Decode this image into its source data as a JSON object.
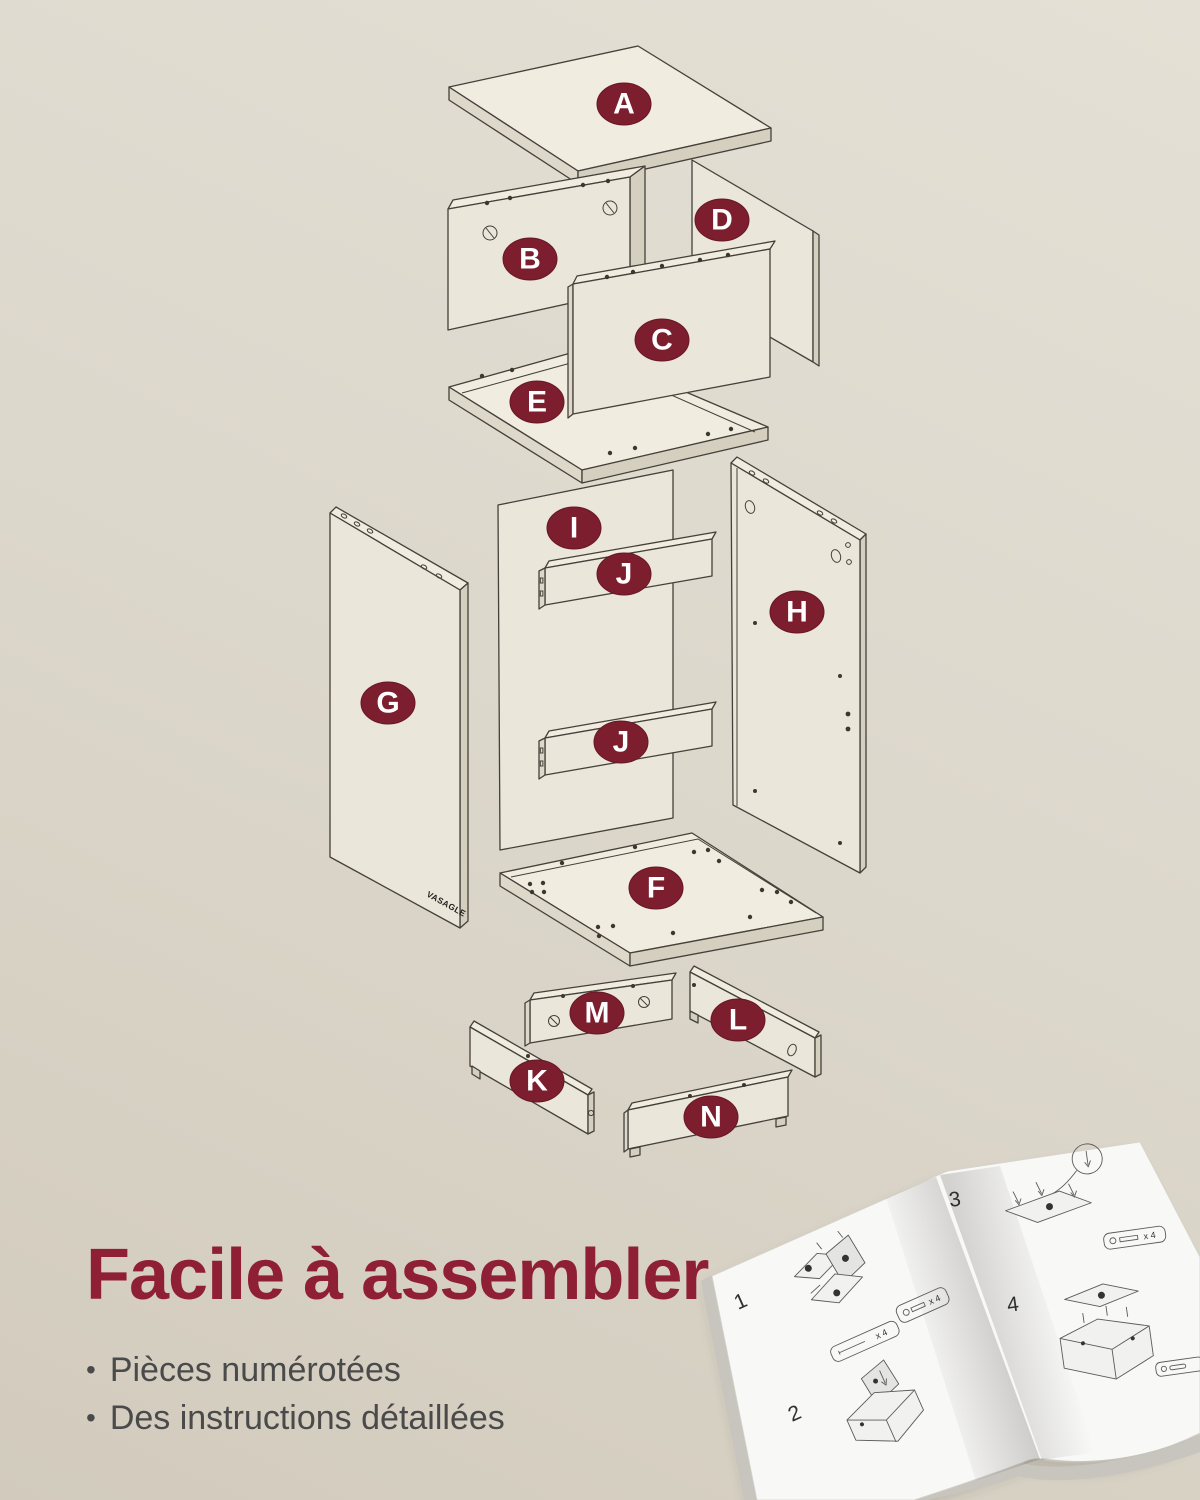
{
  "colors": {
    "badge_fill": "#7d1e2e",
    "badge_stroke": "#671725",
    "badge_text": "#ffffff",
    "title": "#8e1f34",
    "bullet_text": "#4a4a4a",
    "line": "#45403a",
    "panel_face": "#eae6da",
    "panel_edge": "#ded8ca",
    "panel_edge_dark": "#d5cfc0",
    "bg_light": "#e4e0d5",
    "bg_dark": "#d2cbbd"
  },
  "diagram": {
    "badges": [
      {
        "id": "A",
        "label": "A"
      },
      {
        "id": "B",
        "label": "B"
      },
      {
        "id": "C",
        "label": "C"
      },
      {
        "id": "D",
        "label": "D"
      },
      {
        "id": "E",
        "label": "E"
      },
      {
        "id": "F",
        "label": "F"
      },
      {
        "id": "G",
        "label": "G"
      },
      {
        "id": "H",
        "label": "H"
      },
      {
        "id": "I",
        "label": "I"
      },
      {
        "id": "J-upper",
        "label": "J"
      },
      {
        "id": "J-lower",
        "label": "J"
      },
      {
        "id": "K",
        "label": "K"
      },
      {
        "id": "L",
        "label": "L"
      },
      {
        "id": "M",
        "label": "M"
      },
      {
        "id": "N",
        "label": "N"
      }
    ]
  },
  "brand": {
    "logo": "VASAGLE"
  },
  "caption": {
    "title": "Facile à assembler",
    "marker": "•",
    "bullets": [
      {
        "text": "Pièces numérotées"
      },
      {
        "text": "Des instructions détaillées"
      }
    ]
  },
  "manual": {
    "steps": [
      {
        "n": "1"
      },
      {
        "n": "2"
      },
      {
        "n": "3"
      },
      {
        "n": "4"
      }
    ],
    "count_label": "x 4"
  }
}
